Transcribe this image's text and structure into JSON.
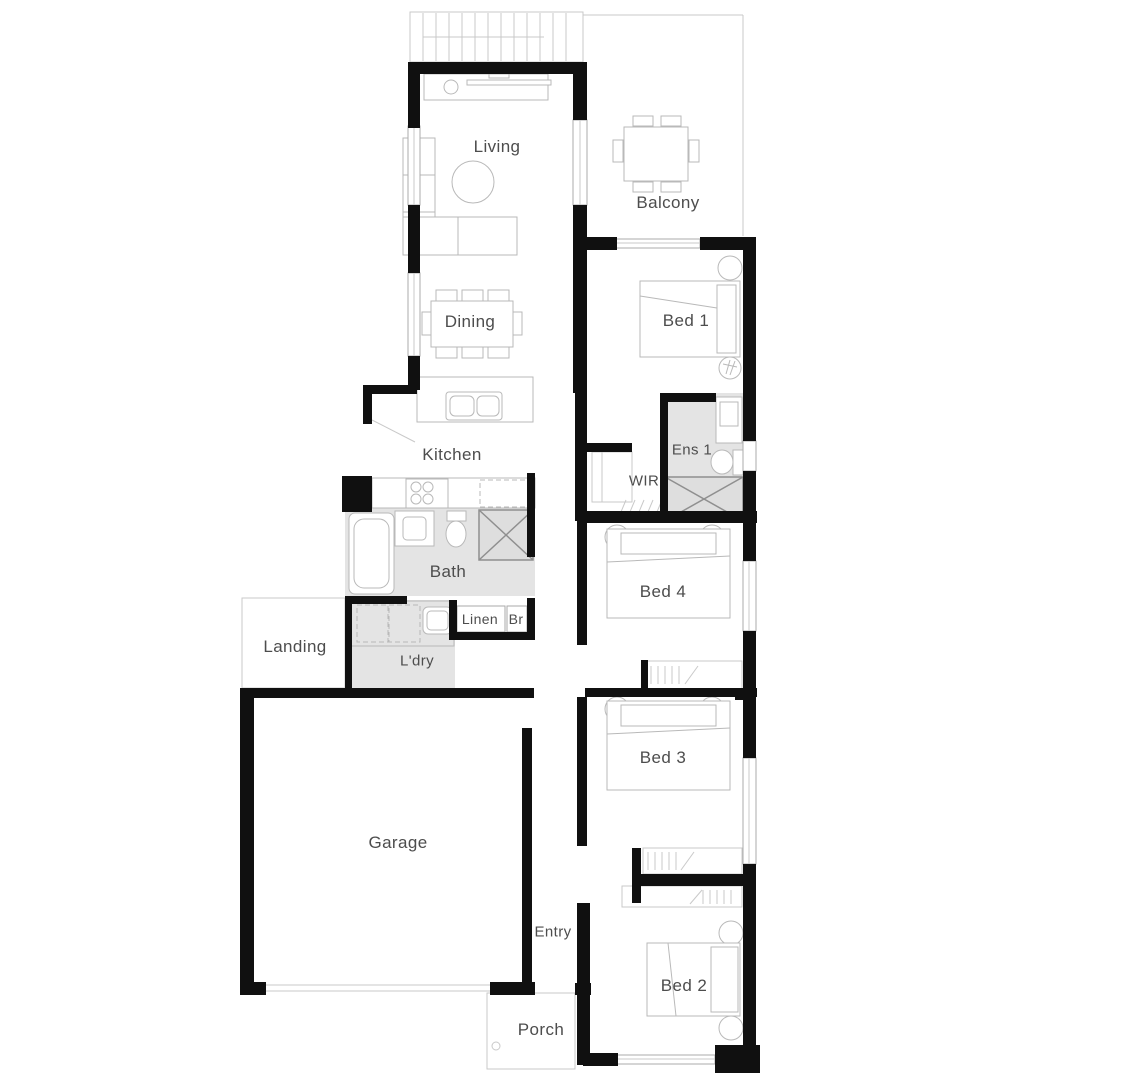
{
  "plan": {
    "rooms": {
      "living": "Living",
      "balcony": "Balcony",
      "bed1": "Bed 1",
      "dining": "Dining",
      "kitchen": "Kitchen",
      "ens1": "Ens 1",
      "wir": "WIR",
      "bath": "Bath",
      "bed4": "Bed 4",
      "linen": "Linen",
      "br": "Br",
      "landing": "Landing",
      "ldry": "L'dry",
      "bed3": "Bed 3",
      "garage": "Garage",
      "entry": "Entry",
      "bed2": "Bed 2",
      "porch": "Porch"
    },
    "colors": {
      "wall": "#101010",
      "wet_area_fill": "#e4e4e4",
      "fixture_line": "#b9b9b9",
      "outline_line": "#c9c9c9",
      "shower_line": "#8f8f8f",
      "label_text": "#4d4d4d",
      "background": "#ffffff"
    }
  }
}
